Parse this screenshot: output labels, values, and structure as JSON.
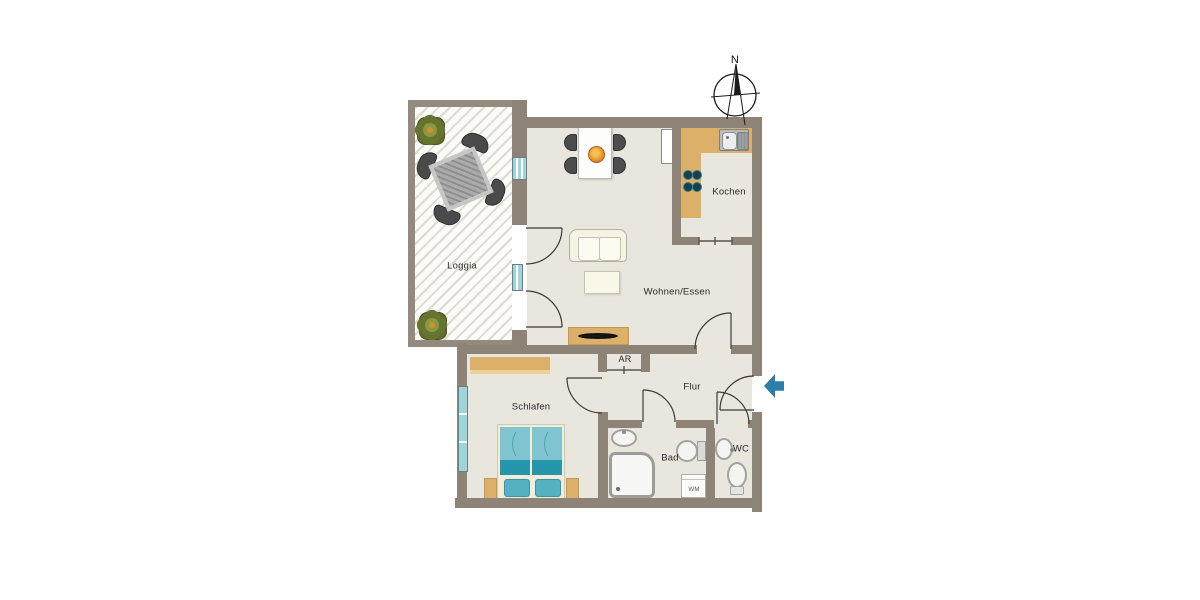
{
  "title": "Apartment floor plan",
  "compass": {
    "north_label": "N"
  },
  "entrance": {
    "symbol": "entrance-arrow",
    "direction": "left"
  },
  "rooms": {
    "loggia": {
      "label": "Loggia"
    },
    "kochen": {
      "label": "Kochen"
    },
    "wohnen": {
      "label": "Wohnen/Essen"
    },
    "ar": {
      "label": "AR"
    },
    "flur": {
      "label": "Flur"
    },
    "schlafen": {
      "label": "Schlafen"
    },
    "bad": {
      "label": "Bad"
    },
    "wc": {
      "label": "WC"
    }
  },
  "appliances": {
    "washing_machine_label": "WM"
  },
  "furniture": [
    "loggia-table-with-4-chairs",
    "plant",
    "plant",
    "dining-table-with-4-chairs",
    "centerpiece-bowl",
    "radiator",
    "sofa",
    "coffee-table",
    "sideboard-with-tv",
    "kitchen-counter",
    "kitchen-sink",
    "stove-4-burners",
    "wardrobe",
    "double-bed",
    "nightstand",
    "nightstand",
    "bathroom-sink",
    "shower",
    "toilet",
    "washing-machine",
    "wc-sink",
    "wc-toilet"
  ],
  "colors": {
    "wall": "#8d8477",
    "floor": "#e9e6de",
    "loggia_stripe": "#dcdad2",
    "counter_tan": "#ddb069",
    "bed_teal_light": "#7fc4cf",
    "bed_teal_dark": "#2596ab",
    "window_glass": "#9ed4db",
    "entrance_arrow": "#2d7ea8",
    "door_line": "#3a3a3a",
    "text": "#2b2b2b"
  }
}
